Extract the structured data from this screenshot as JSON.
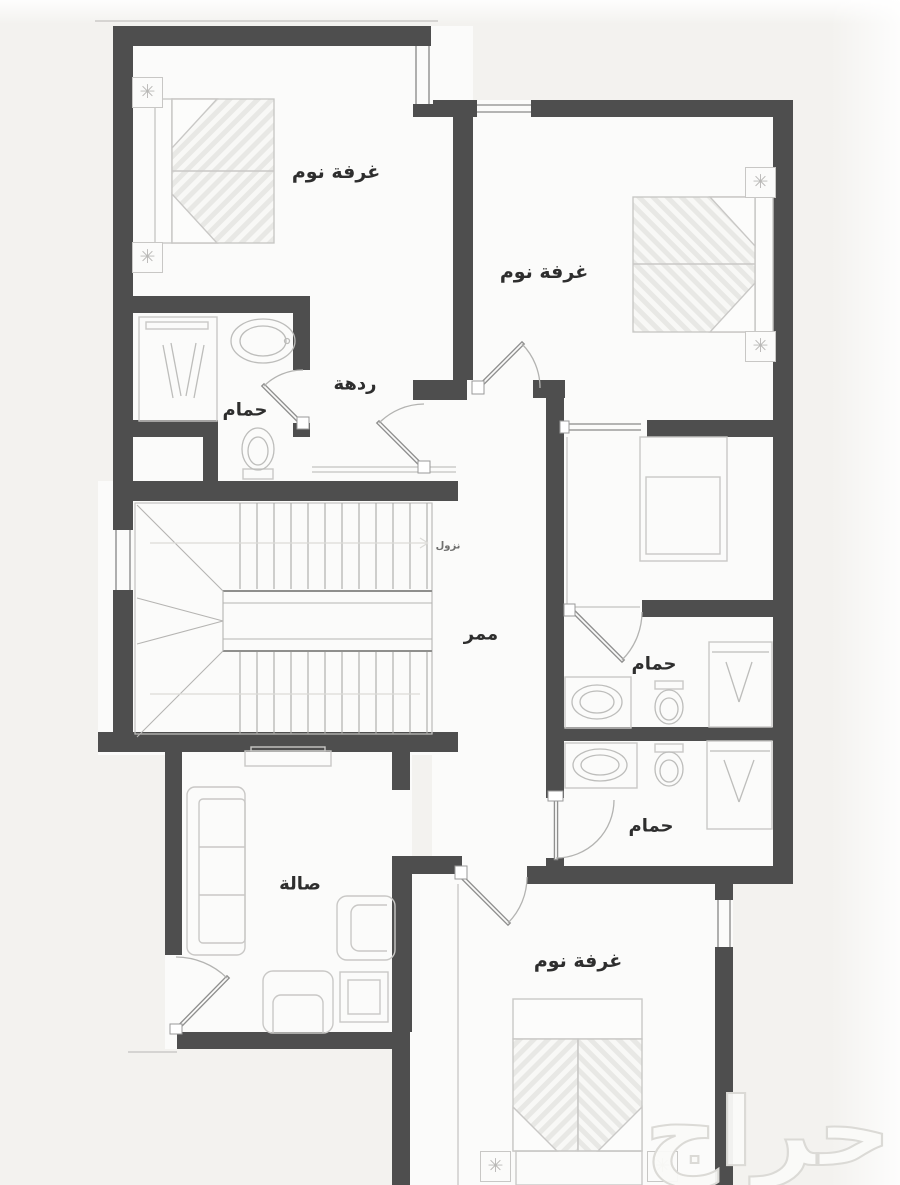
{
  "plan": {
    "rooms": {
      "bedroom_top_left": "غرفة نوم",
      "bedroom_top_right": "غرفة نوم",
      "bedroom_bottom": "غرفة نوم",
      "hall": "ردهة",
      "bathroom_left": "حمام",
      "bathroom_middle": "حمام",
      "bathroom_lower": "حمام",
      "corridor": "ممر",
      "living_room": "صالة",
      "stairs_direction": "نزول"
    },
    "watermark": "حراج",
    "icons": {
      "ac_unit": "✳"
    },
    "colors": {
      "wall": "#4e4e4e",
      "furniture_line": "#c9c8c6",
      "door_line": "#8f8f8e",
      "label": "#2e2e2e",
      "background": "#f3f2ef",
      "floor": "#fbfbfa",
      "watermark": "#dbdad6"
    }
  }
}
